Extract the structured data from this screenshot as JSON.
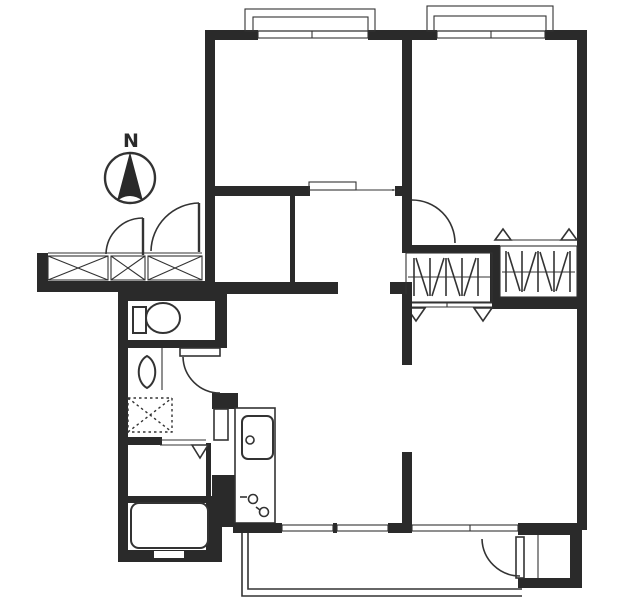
{
  "document": {
    "kind": "scanned-apartment-floor-plan",
    "orientation_note": "north is up"
  },
  "compass": {
    "label": "N",
    "icon": "north-compass-icon"
  },
  "colors": {
    "wall": "#2a2a2a",
    "line": "#333333",
    "paper": "#ffffff"
  },
  "fixtures": [
    {
      "icon": "toilet-icon"
    },
    {
      "icon": "washbasin-icon"
    },
    {
      "icon": "washing-machine-pan-icon"
    },
    {
      "icon": "bathtub-icon"
    },
    {
      "icon": "kitchen-counter-icon"
    },
    {
      "icon": "kitchen-sink-icon"
    },
    {
      "icon": "stove-burner-icon"
    },
    {
      "icon": "futon-closet-icon"
    },
    {
      "icon": "sliding-window-icon"
    },
    {
      "icon": "swing-door-icon"
    },
    {
      "icon": "entrance-step-icon"
    },
    {
      "icon": "balcony-railing-icon"
    }
  ]
}
